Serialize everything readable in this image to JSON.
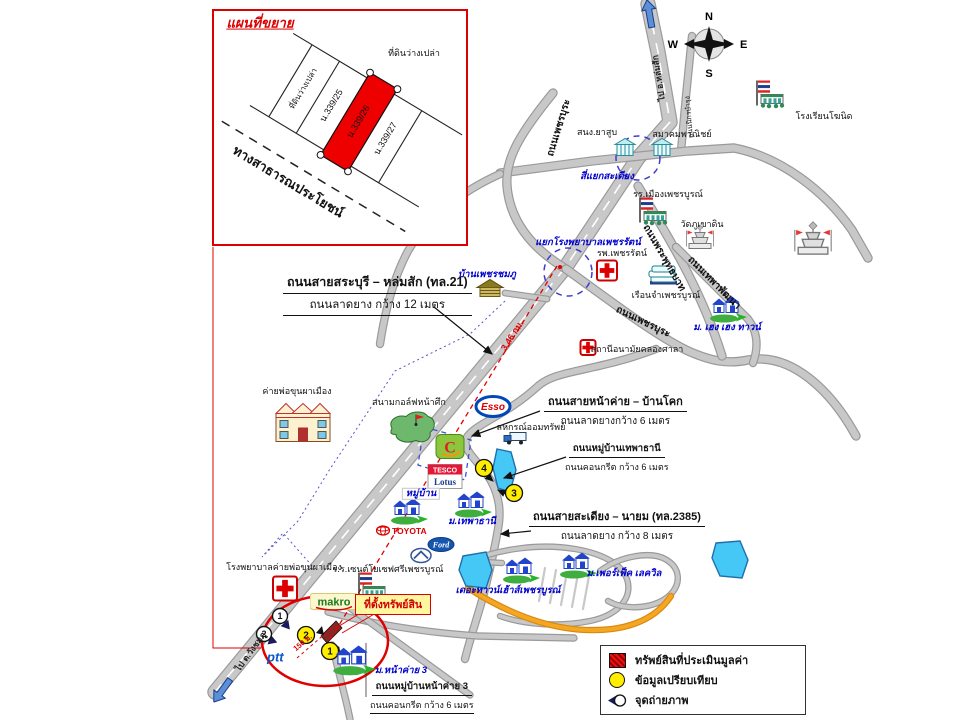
{
  "colors": {
    "road": "#c8c8c8",
    "road_outline": "#9a9a9a",
    "orange_road": "#f5a623",
    "pond": "#45c8f5",
    "accent_red": "#dd0000",
    "blue_label": "#0000cc",
    "property_red": "#ee0000",
    "yellow": "#ffee00"
  },
  "compass": {
    "n": "N",
    "e": "E",
    "s": "S",
    "w": "W"
  },
  "inset": {
    "title": "แผนที่ขยาย"
  },
  "property_box": {
    "text": "ที่ตั้งทรัพย์สิน"
  },
  "legend": {
    "items": [
      {
        "icon": "legend-red-hatch-swatch",
        "label": "ทรัพย์สินที่ประเมินมูลค่า"
      },
      {
        "icon": "legend-yellow-circle-swatch",
        "label": "ข้อมูลเปรียบเทียบ"
      },
      {
        "icon": "legend-camera-icon",
        "label": "จุดถ่ายภาพ"
      }
    ]
  },
  "labels": [
    {
      "n": "inset-title",
      "t": "แผนที่ขยาย",
      "x": 260,
      "y": 24,
      "c": "inset-title"
    },
    {
      "n": "inset-vacant-land-top",
      "t": "ที่ดินว่างเปล่า",
      "x": 414,
      "y": 54,
      "c": "pl"
    },
    {
      "n": "inset-strip-vacant",
      "t": "ที่ดินว่างเปล่า",
      "x": 304,
      "y": 89,
      "r": -59,
      "c": "pl-s"
    },
    {
      "n": "inset-strip-339-25",
      "t": "น.339/25",
      "x": 332,
      "y": 106,
      "r": -59,
      "c": "pl"
    },
    {
      "n": "inset-strip-339-26",
      "t": "น.339/26",
      "x": 359,
      "y": 122,
      "r": -59,
      "c": "pl"
    },
    {
      "n": "inset-strip-339-27",
      "t": "น.339/27",
      "x": 386,
      "y": 139,
      "r": -59,
      "c": "pl"
    },
    {
      "n": "inset-public-road-label",
      "t": "ทางสาธารณประโยชน์",
      "x": 288,
      "y": 182,
      "r": 31,
      "c": "big-bold"
    },
    {
      "n": "to-lomsak-label",
      "t": "ไป อ.หล่มสัก",
      "x": 659,
      "y": 78,
      "r": -99,
      "c": "on-road"
    },
    {
      "n": "to-wangchomphu-label",
      "t": "ไป ต.วังชมภู",
      "x": 251,
      "y": 652,
      "r": -54,
      "c": "on-road"
    },
    {
      "n": "khosit-school-label",
      "t": "โรงเรียนโฆนิด",
      "x": 824,
      "y": 117,
      "c": "pl"
    },
    {
      "n": "nikorn-bamrung-road-label",
      "t": "ถนนนิกรบำรุง",
      "x": 690,
      "y": 117,
      "r": -95,
      "c": "tiny"
    },
    {
      "n": "tobacco-office-label",
      "t": "สนง.ยาสูบ",
      "x": 597,
      "y": 133,
      "c": "pl"
    },
    {
      "n": "commerce-assoc-label",
      "t": "สมาคมพาณิชย์",
      "x": 682,
      "y": 135,
      "c": "pl"
    },
    {
      "n": "sadiang-intersection-label",
      "t": "สี่แยกสะเดียง",
      "x": 607,
      "y": 177,
      "c": "bl"
    },
    {
      "n": "mueang-school-label",
      "t": "รร.เมืองเพชรบูรณ์",
      "x": 668,
      "y": 195,
      "c": "pl"
    },
    {
      "n": "wat-phukhaodin-label",
      "t": "วัดภูเขาดิน",
      "x": 702,
      "y": 225,
      "c": "pl"
    },
    {
      "n": "phetcharat-junction-label",
      "t": "แยกโรงพยาบาลเพชรรัตน์",
      "x": 588,
      "y": 243,
      "c": "bl"
    },
    {
      "n": "phetcharat-hospital-label",
      "t": "รพ.เพชรรัตน์",
      "x": 622,
      "y": 254,
      "c": "pl"
    },
    {
      "n": "prison-label",
      "t": "เรือนจำเพชรบูรณ์",
      "x": 666,
      "y": 296,
      "c": "pl"
    },
    {
      "n": "heng-heng-town-label",
      "t": "ม. เฮง เฮง ทาวน์",
      "x": 727,
      "y": 328,
      "c": "bl"
    },
    {
      "n": "khlongsala-clinic-label",
      "t": "สถานีอนามัยคลองศาลา",
      "x": 637,
      "y": 350,
      "c": "pl"
    },
    {
      "n": "ban-phetchomphu-label",
      "t": "บ้านเพชรชมภู",
      "x": 487,
      "y": 275,
      "c": "bl"
    },
    {
      "n": "phetbura-road-label-north",
      "t": "ถนนเพชรบุระ",
      "x": 559,
      "y": 128,
      "r": -73,
      "c": "rd"
    },
    {
      "n": "phetbura-road-label-south",
      "t": "ถนนเพชรบุระ",
      "x": 643,
      "y": 322,
      "r": 26,
      "c": "rd"
    },
    {
      "n": "phraphutthabat-road-label",
      "t": "ถนนพระพุทธบาท",
      "x": 664,
      "y": 258,
      "r": 60,
      "c": "rd"
    },
    {
      "n": "thepha-phatthana-road-label",
      "t": "ถนนเทพาพัฒนา",
      "x": 714,
      "y": 283,
      "r": 45,
      "c": "rd"
    },
    {
      "n": "distance-346km-label",
      "t": "3.46 กม.",
      "x": 513,
      "y": 336,
      "r": -57,
      "c": "redr"
    },
    {
      "n": "coop-label",
      "t": "สหกรณ์ออมทรัพย์",
      "x": 531,
      "y": 428,
      "c": "pl"
    },
    {
      "n": "camp-label",
      "t": "ค่ายพ่อขุนผาเมือง",
      "x": 297,
      "y": 392,
      "c": "pl"
    },
    {
      "n": "golf-label",
      "t": "สนามกอล์ฟหน้าศึก",
      "x": 409,
      "y": 403,
      "c": "pl"
    },
    {
      "n": "muban-label",
      "t": "หมู่บ้าน",
      "x": 421,
      "y": 494,
      "c": "bl bgbox"
    },
    {
      "n": "thephathani-label",
      "t": "ม.เทพาธานี",
      "x": 472,
      "y": 522,
      "c": "bl"
    },
    {
      "n": "townhouse-label",
      "t": "เดอะทาวน์เฮ้าส์เพชรบูรณ์",
      "x": 508,
      "y": 591,
      "c": "bl"
    },
    {
      "n": "perfect-lakeville-label",
      "t": "ม.เพอร์เฟ็ค เลควิล",
      "x": 624,
      "y": 574,
      "c": "bl"
    },
    {
      "n": "camp-hospital-label",
      "t": "โรงพยาบาลค่ายพ่อขุนผาเมือง",
      "x": 284,
      "y": 568,
      "c": "pl"
    },
    {
      "n": "stjoseph-school-label",
      "t": "ร.ร.เซนต์โยเซฟศรีเพชรบูรณ์",
      "x": 388,
      "y": 570,
      "c": "pl"
    },
    {
      "n": "nakhlai3-label",
      "t": "ม.หน้าค่าย 3",
      "x": 401,
      "y": 671,
      "c": "bl"
    },
    {
      "n": "distance-150m-label",
      "t": "150 ม.",
      "x": 303,
      "y": 643,
      "r": -40,
      "c": "redr-s"
    }
  ],
  "callouts": [
    {
      "n": "callout-saraburi-lomsak",
      "title": "ถนนสายสระบุรี – หล่มสัก (ทล.21)",
      "sub": "ถนนลาดยาง กว้าง 12 เมตร",
      "x": 283,
      "y": 272,
      "c": "big sub-u"
    },
    {
      "n": "callout-nakhlai-bankok",
      "title": "ถนนสายหน้าค่าย – บ้านโคก",
      "sub": "ถนนลาดยางกว้าง 6 เมตร",
      "x": 544,
      "y": 392,
      "c": "mid"
    },
    {
      "n": "callout-thephathani-village-road",
      "title": "ถนนหมู่บ้านเทพาธานี",
      "sub": "ถนนคอนกรีต กว้าง 6 เมตร",
      "x": 565,
      "y": 438,
      "c": "sm"
    },
    {
      "n": "callout-sadiang-nayom",
      "title": "ถนนสายสะเดียง – นายม (ทล.2385)",
      "sub": "ถนนลาดยาง กว้าง 8 เมตร",
      "x": 529,
      "y": 507,
      "c": "mid"
    },
    {
      "n": "callout-nakhlai3-road",
      "title": "ถนนหมู่บ้านหน้าค่าย 3",
      "sub": "ถนนคอนกรีต กว้าง 6 เมตร",
      "x": 370,
      "y": 676,
      "c": "sm sub-u"
    }
  ],
  "roads": [
    {
      "n": "highway-21",
      "d": "M 648,4 L 658,52 L 670,122 L 638,158 L 565,268 L 215,692",
      "w": 13,
      "cd": true
    },
    {
      "n": "nikorn-bamrung-road",
      "d": "M 692,36 L 686,96 L 681,151",
      "w": 6
    },
    {
      "n": "sadiang-cross-road",
      "d": "M 500,173 L 592,161 L 688,151 L 734,148 C 780,157 824,190 852,230 L 868,258",
      "w": 7
    },
    {
      "n": "phetbura-road-north",
      "d": "M 553,93 C 518,136 505,160 507,186 C 510,222 533,249 566,269",
      "w": 7
    },
    {
      "n": "phetbura-road-southeast",
      "d": "M 566,269 C 612,302 652,333 686,350 C 712,362 729,364 748,360 C 792,352 832,392 856,436",
      "w": 7
    },
    {
      "n": "phraphutthabat-road",
      "d": "M 638,186 C 672,243 702,292 722,356",
      "w": 7
    },
    {
      "n": "thepha-phatthana-road",
      "d": "M 676,247 L 748,319 C 757,331 759,346 753,363",
      "w": 6
    },
    {
      "n": "west-branch-road",
      "d": "M 500,174 C 462,191 428,217 408,251 C 394,277 385,311 380,344",
      "w": 6
    },
    {
      "n": "nakhlai-bankok-road",
      "d": "M 656,349 C 592,373 556,369 537,387 C 504,417 472,425 466,439 C 462,451 481,463 491,481 C 500,498 501,513 498,529 C 494,553 489,573 484,593 C 478,616 471,635 465,659",
      "w": 6
    },
    {
      "n": "phetchomphu-access-road",
      "d": "M 505,293 L 547,299",
      "w": 4.5
    },
    {
      "n": "makro-road",
      "d": "M 328,612 C 372,624 420,632 478,636 L 574,638",
      "w": 5
    },
    {
      "n": "stjoseph-road",
      "d": "M 349,607 L 470,695",
      "w": 5
    },
    {
      "n": "nakhlai3-village-road",
      "d": "M 332,645 L 346,701 L 350,719",
      "w": 5
    },
    {
      "n": "village-loop-road-1",
      "d": "M 470,561 C 500,549 540,543 575,549 C 605,554 625,566 628,583 C 631,601 615,616 590,621 C 560,627 525,625 500,616",
      "w": 4
    },
    {
      "n": "village-loop-road-2",
      "d": "M 600,571 C 620,556 650,551 665,559 C 680,567 682,583 670,595 C 655,609 625,611 608,601",
      "w": 4
    },
    {
      "n": "village-connector-road",
      "d": "M 466,561 L 502,563",
      "w": 4
    },
    {
      "n": "village-streets-hatch",
      "d": "M 545,568 L 539,601 M 556,570 L 550,603 M 567,572 L 561,605 M 578,574 L 572,607 M 589,576 L 583,609",
      "w": 2.2,
      "flat": true
    },
    {
      "n": "orange-road",
      "d": "M 468,588 C 512,616 560,635 612,629 C 643,625 661,611 671,596",
      "w": 4,
      "color": "#f5a623",
      "oc": "#d88a10"
    }
  ],
  "paths": [
    {
      "n": "red-distance-line",
      "d": "M 557,266 L 330,640",
      "s": "#e00000",
      "w": 1.3,
      "dash": "5,4"
    },
    {
      "n": "red-150m-line",
      "d": "M 297,658 L 334,626",
      "s": "#e00000",
      "w": 1,
      "dash": "3,3"
    },
    {
      "n": "inset-leader-line",
      "d": "M 213,247 L 213,648 L 261,648",
      "s": "#e00000",
      "w": 1
    },
    {
      "n": "propbox-leader-1",
      "d": "M 362,612 L 336,628",
      "s": "#e00000",
      "w": 1
    },
    {
      "n": "propbox-leader-2",
      "d": "M 376,613 L 342,633",
      "s": "#e00000",
      "w": 1
    },
    {
      "n": "blue-dotted-boundary",
      "d": "M 505,301 L 470,334 L 395,371 L 330,469 L 298,521 L 262,557 L 283,533 L 313,567",
      "s": "#5555cc",
      "w": 1,
      "dash": "2,3"
    },
    {
      "n": "arrow-callout-1",
      "d": "M 434,307 L 492,354",
      "s": "#111",
      "w": 1.2,
      "m": true
    },
    {
      "n": "arrow-callout-2",
      "d": "M 540,411 L 472,436",
      "s": "#111",
      "w": 1.2,
      "m": true
    },
    {
      "n": "arrow-callout-3",
      "d": "M 566,457 L 504,478",
      "s": "#111",
      "w": 1.2,
      "m": true
    },
    {
      "n": "arrow-callout-4",
      "d": "M 531,531 L 501,534",
      "s": "#111",
      "w": 1.2,
      "m": true
    },
    {
      "n": "arrow-point-4",
      "d": "M 484,473 L 493,481",
      "s": "#111",
      "w": 1.1,
      "m": true
    },
    {
      "n": "arrow-point-3",
      "d": "M 508,495 L 498,490",
      "s": "#111",
      "w": 1.1,
      "m": true
    },
    {
      "n": "nakhlai3-bracket-line",
      "d": "M 366,643 L 366,697",
      "s": "#333",
      "w": 0.8
    }
  ],
  "shapes": [
    {
      "n": "pond-1",
      "type": "polygon",
      "pts": "497,449 511,452 516,470 510,492 498,488 493,468",
      "f": "#45c8f5",
      "s": "#1f6fae",
      "w": 1.4
    },
    {
      "n": "pond-2",
      "type": "polygon",
      "pts": "463,556 486,552 492,570 486,588 466,586 459,570",
      "f": "#45c8f5",
      "s": "#1f6fae",
      "w": 1.4
    },
    {
      "n": "pond-3",
      "type": "polygon",
      "pts": "716,543 740,541 748,560 742,578 720,576 712,558",
      "f": "#45c8f5",
      "s": "#1f6fae",
      "w": 1.4
    },
    {
      "n": "bigc-site-outline",
      "type": "polygon",
      "pts": "424,427 471,440 465,480 418,465",
      "f": "none",
      "s": "#3a55cc",
      "w": 1.3,
      "dash": "5,4"
    },
    {
      "n": "subject-property-plot",
      "type": "polygon",
      "pts": "327,643 321,636 336,621 342,628",
      "f": "#8a2525",
      "s": "#111",
      "w": 0.8
    },
    {
      "n": "highlight-ellipse",
      "type": "ellipse",
      "cx": 325,
      "cy": 641,
      "rx": 63,
      "ry": 45,
      "f": "none",
      "s": "#e00000",
      "w": 2.5
    },
    {
      "n": "sadiang-junction-circle",
      "type": "circle",
      "cx": 638,
      "cy": 158,
      "rr": 22,
      "f": "none",
      "s": "#3b3bd0",
      "w": 1.5,
      "dash": "6,5"
    },
    {
      "n": "hospital-junction-circle",
      "type": "circle",
      "cx": 568,
      "cy": 272,
      "rr": 24,
      "f": "none",
      "s": "#3b3bd0",
      "w": 1.5,
      "dash": "6,5"
    },
    {
      "n": "measure-tick-1",
      "type": "polygon",
      "pts": "316,633 322,626 324,635",
      "f": "#111",
      "s": "none",
      "w": 0
    },
    {
      "n": "measure-tick-2",
      "type": "polygon",
      "pts": "333,653 339,646 341,655",
      "f": "#111",
      "s": "none",
      "w": 0
    },
    {
      "n": "junction-red-dot",
      "type": "circle",
      "cx": 560,
      "cy": 267,
      "rr": 2,
      "f": "#e00000",
      "s": "none",
      "w": 0
    }
  ],
  "markers": {
    "comparison": [
      {
        "num": "4",
        "x": 484,
        "y": 468
      },
      {
        "num": "3",
        "x": 514,
        "y": 493
      },
      {
        "num": "2",
        "x": 306,
        "y": 635
      },
      {
        "num": "1",
        "x": 330,
        "y": 651
      }
    ],
    "photo": [
      {
        "num": "1",
        "x": 280,
        "y": 616,
        "tx": 287,
        "ty": 626,
        "tr": 140
      },
      {
        "num": "2",
        "x": 264,
        "y": 634,
        "tx": 273,
        "ty": 641,
        "tr": 110
      }
    ]
  },
  "icons": [
    {
      "t": "flagschool",
      "n": "khosit-school-icon",
      "x": 770,
      "y": 96
    },
    {
      "t": "flagschool",
      "n": "mueang-phetchabun-school-icon",
      "x": 653,
      "y": 213
    },
    {
      "t": "flagschool",
      "n": "saint-joseph-school-icon",
      "x": 372,
      "y": 588
    },
    {
      "t": "govbldg",
      "n": "tobacco-office-icon",
      "x": 625,
      "y": 150
    },
    {
      "t": "govbldg",
      "n": "commerce-assoc-icon",
      "x": 662,
      "y": 150
    },
    {
      "t": "temple",
      "n": "wat-phukhaodin-icon",
      "x": 700,
      "y": 241
    },
    {
      "t": "temple",
      "n": "stupa-icon",
      "x": 813,
      "y": 244,
      "s": 1.35
    },
    {
      "t": "cross",
      "n": "phetcharat-hospital-icon",
      "x": 607,
      "y": 273,
      "sz": 22
    },
    {
      "t": "cross",
      "n": "khlongsala-clinic-icon",
      "x": 588,
      "y": 350,
      "sz": 17
    },
    {
      "t": "cross",
      "n": "camp-hospital-icon",
      "x": 285,
      "y": 591,
      "sz": 26
    },
    {
      "t": "prison",
      "n": "prison-icon",
      "x": 663,
      "y": 277
    },
    {
      "t": "housetan",
      "n": "ban-phetchomphu-icon",
      "x": 490,
      "y": 291
    },
    {
      "t": "houses",
      "n": "heng-heng-town-icon",
      "x": 728,
      "y": 310
    },
    {
      "t": "houses",
      "n": "thephathani-village-icon",
      "x": 473,
      "y": 505
    },
    {
      "t": "houses",
      "n": "muban-icon",
      "x": 409,
      "y": 512
    },
    {
      "t": "houses",
      "n": "perfect-lakeville-icon",
      "x": 578,
      "y": 566
    },
    {
      "t": "houses",
      "n": "townhouse-icon",
      "x": 521,
      "y": 571
    },
    {
      "t": "houses",
      "n": "nakhlai3-village-icon",
      "x": 354,
      "y": 661,
      "s": 1.15
    },
    {
      "t": "camp",
      "n": "camp-building-icon",
      "x": 303,
      "y": 425
    },
    {
      "t": "golf",
      "n": "golf-course-icon",
      "x": 412,
      "y": 429
    },
    {
      "t": "esso",
      "n": "esso-logo",
      "x": 493,
      "y": 409,
      "text": "Esso"
    },
    {
      "t": "bigc",
      "n": "bigc-logo",
      "x": 450,
      "y": 449,
      "text": "C"
    },
    {
      "t": "tesco",
      "n": "tesco-lotus-logo",
      "x": 445,
      "y": 479,
      "text": "TESCO",
      "text2": "Lotus"
    },
    {
      "t": "coop",
      "n": "coop-truck-icon",
      "x": 515,
      "y": 440
    },
    {
      "t": "toyota",
      "n": "toyota-logo",
      "x": 404,
      "y": 533,
      "text": "TOYOTA"
    },
    {
      "t": "ford",
      "n": "ford-logo",
      "x": 441,
      "y": 547,
      "text": "Ford"
    },
    {
      "t": "mazda",
      "n": "mazda-logo",
      "x": 421,
      "y": 558
    },
    {
      "t": "makro",
      "n": "makro-logo",
      "x": 334,
      "y": 604,
      "text": "makro"
    },
    {
      "t": "ptt",
      "n": "ptt-logo",
      "x": 280,
      "y": 659,
      "text": "ptt"
    },
    {
      "t": "bluearrow",
      "n": "north-direction-arrow",
      "x": 650,
      "y": 17,
      "r": -10
    },
    {
      "t": "bluearrow",
      "n": "southwest-direction-arrow",
      "x": 224,
      "y": 688,
      "r": 216
    }
  ]
}
